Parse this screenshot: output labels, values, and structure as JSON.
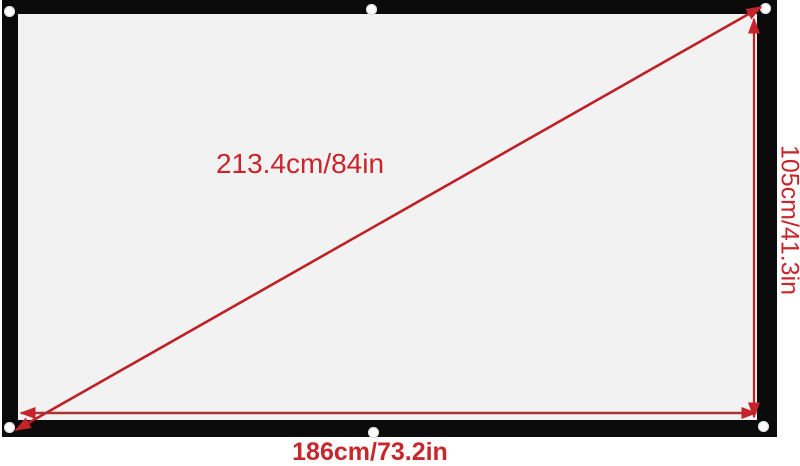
{
  "screen": {
    "frame_color": "#0b0b0b",
    "surface_color": "#f2f2f2",
    "grommet_color": "#ffffff",
    "grommet_count": 6
  },
  "annotations": {
    "color": "#c5222a",
    "diagonal": {
      "label": "213.4cm/84in"
    },
    "height": {
      "label": "105cm/41.3in"
    },
    "width": {
      "label": "186cm/73.2in"
    }
  }
}
